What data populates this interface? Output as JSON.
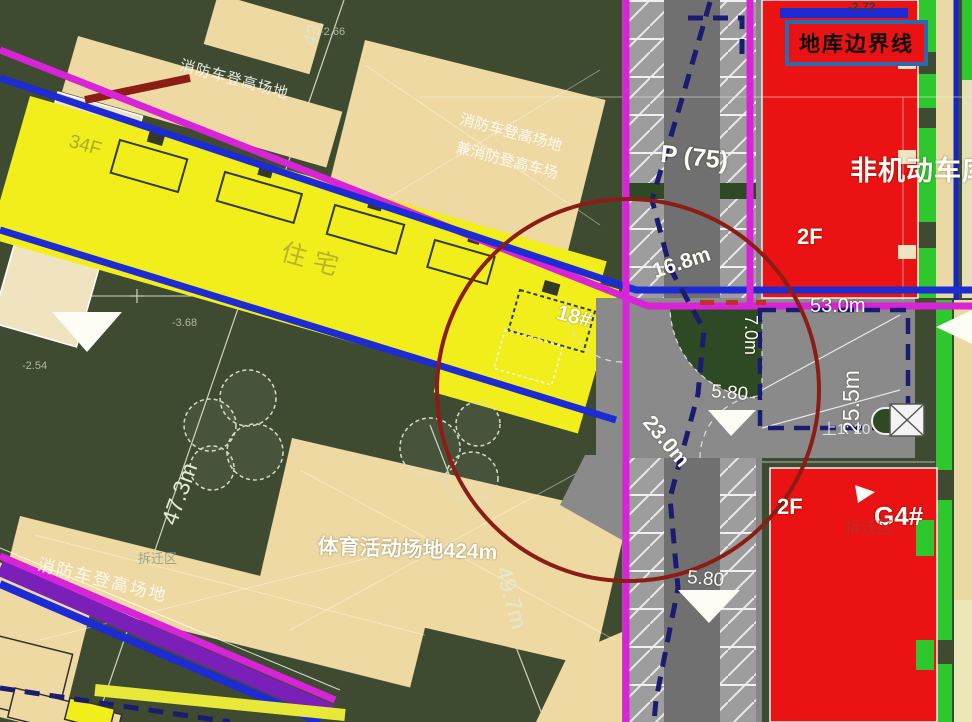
{
  "title_note": "residential site plan with underground garage boundary",
  "colors": {
    "background_green": "#3e4b31",
    "building_yellow": "#f2ee1b",
    "fire_lane_tan": "#efd9a2",
    "road_gray": "#868686",
    "red_building": "#ea1212",
    "magenta_line": "#d923d9",
    "blue_line": "#1c2bd4",
    "dashed_navy": "#1b1b70",
    "circle_red": "#8b1d15",
    "bright_green": "#2ec82e"
  },
  "legend": {
    "garage_boundary_line": "地库边界线"
  },
  "buildings": {
    "residential": {
      "name": "住宅",
      "floors": "34F",
      "unit": "18#"
    },
    "nonmotor_garage": {
      "name": "非机动车库",
      "floors_top": "2F"
    },
    "g4": {
      "unit": "G4#",
      "floors": "2F",
      "demolition": "拆迁区"
    }
  },
  "areas": {
    "parking_count": "P (75)",
    "ramp_slope": "上1: 20",
    "sports_field": "体育活动场地424m",
    "fire_lane_top_left": "消防车登高场地",
    "fire_lane_mid_line1": "消防车登高场地",
    "fire_lane_mid_line2": "兼消防登高车场",
    "fire_lane_bottom_left": "消防车登高场地",
    "demolition_left": "拆迁区"
  },
  "dimensions": {
    "d43": "43.",
    "d473": "47.3m",
    "d497": "49.7m",
    "d168": "16.8m",
    "d70": "7.0m",
    "d230": "23.0m",
    "d580a": "5.80",
    "d580b": "5.80",
    "d530": "53.0m",
    "d255": "25.5m"
  },
  "elevations": {
    "e272": "-2.72",
    "e266": "-2.66",
    "e368": "-3.68",
    "e254": "-2.54"
  }
}
